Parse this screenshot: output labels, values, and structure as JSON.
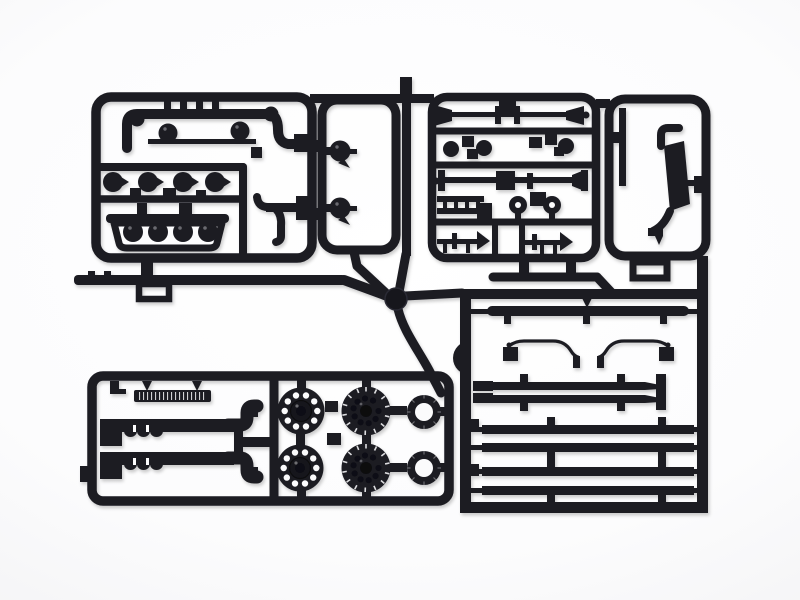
{
  "meta": {
    "title": "Black plastic model kit sprue photographed on a white background",
    "aria_label": "Product photograph of a single dark gray injection-molded sprue (parts tree) for a truck model kit, containing engine parts, cab panels, small fittings, a door panel, exhaust pipes with mufflers, six wheel hubs and rings, and long chassis rails, all still attached to the rectangular runner frames."
  },
  "theme": {
    "plastic_color": "#1d1d24",
    "plastic_shadow_color": "#0d0d12",
    "background_color": "#ffffff",
    "vignette_color": "#e7e7ea",
    "photo_shadow_opacity": "0.22"
  },
  "scene": {
    "object": "injection-molded model kit sprue (runner with parts)",
    "material_look": "matte black styrene plastic",
    "sections": [
      {
        "id": "engine-section",
        "position": "top-left",
        "parts": [
          "u-shaped pipe with two round pads",
          "two dome air cleaners joined by a rod",
          "four round cap knobs with pointed nubs",
          "oil-pan tub holding four dome pistons",
          "two-prong fork bracket"
        ]
      },
      {
        "id": "cab-panel-loop",
        "position": "top-center-left",
        "parts": [
          "rounded rectangular window frame",
          "two teardrop dome lamps"
        ]
      },
      {
        "id": "fittings-section",
        "position": "top-center-right",
        "parts": [
          "two air horns on rods",
          "round knobs and square fittings",
          "long axle rod with center block",
          "small ladder grille",
          "two donut pulleys",
          "two small horns"
        ]
      },
      {
        "id": "door-panel-section",
        "position": "top-right",
        "parts": [
          "thin pillar strip",
          "curved fender band with end hooks",
          "small rectangular loop"
        ]
      },
      {
        "id": "chassis-section",
        "position": "right-bottom",
        "parts": [
          "leaf spring bar",
          "two thin brake lines with end blocks",
          "half-ring",
          "pair of short drag-link bars",
          "four long chassis rails"
        ]
      },
      {
        "id": "exhaust-wheel-section",
        "position": "bottom-left",
        "parts": [
          "ribbed tread plate",
          "two L-shaped exhaust pipes with finned mufflers",
          "two perforated wheel hubs",
          "two bolt-pattern wheel hubs",
          "two wheel rings"
        ]
      }
    ],
    "counts": {
      "perforated_hubs": 2,
      "holes_per_perforated_hub": 10,
      "bolt_pattern_hubs": 2,
      "wheel_rings": 2,
      "long_chassis_rails": 4,
      "exhaust_pipes": 2,
      "dome_pistons_in_tub": 4,
      "cap_knobs_row": 4,
      "sprue_gate_node": 1
    }
  }
}
